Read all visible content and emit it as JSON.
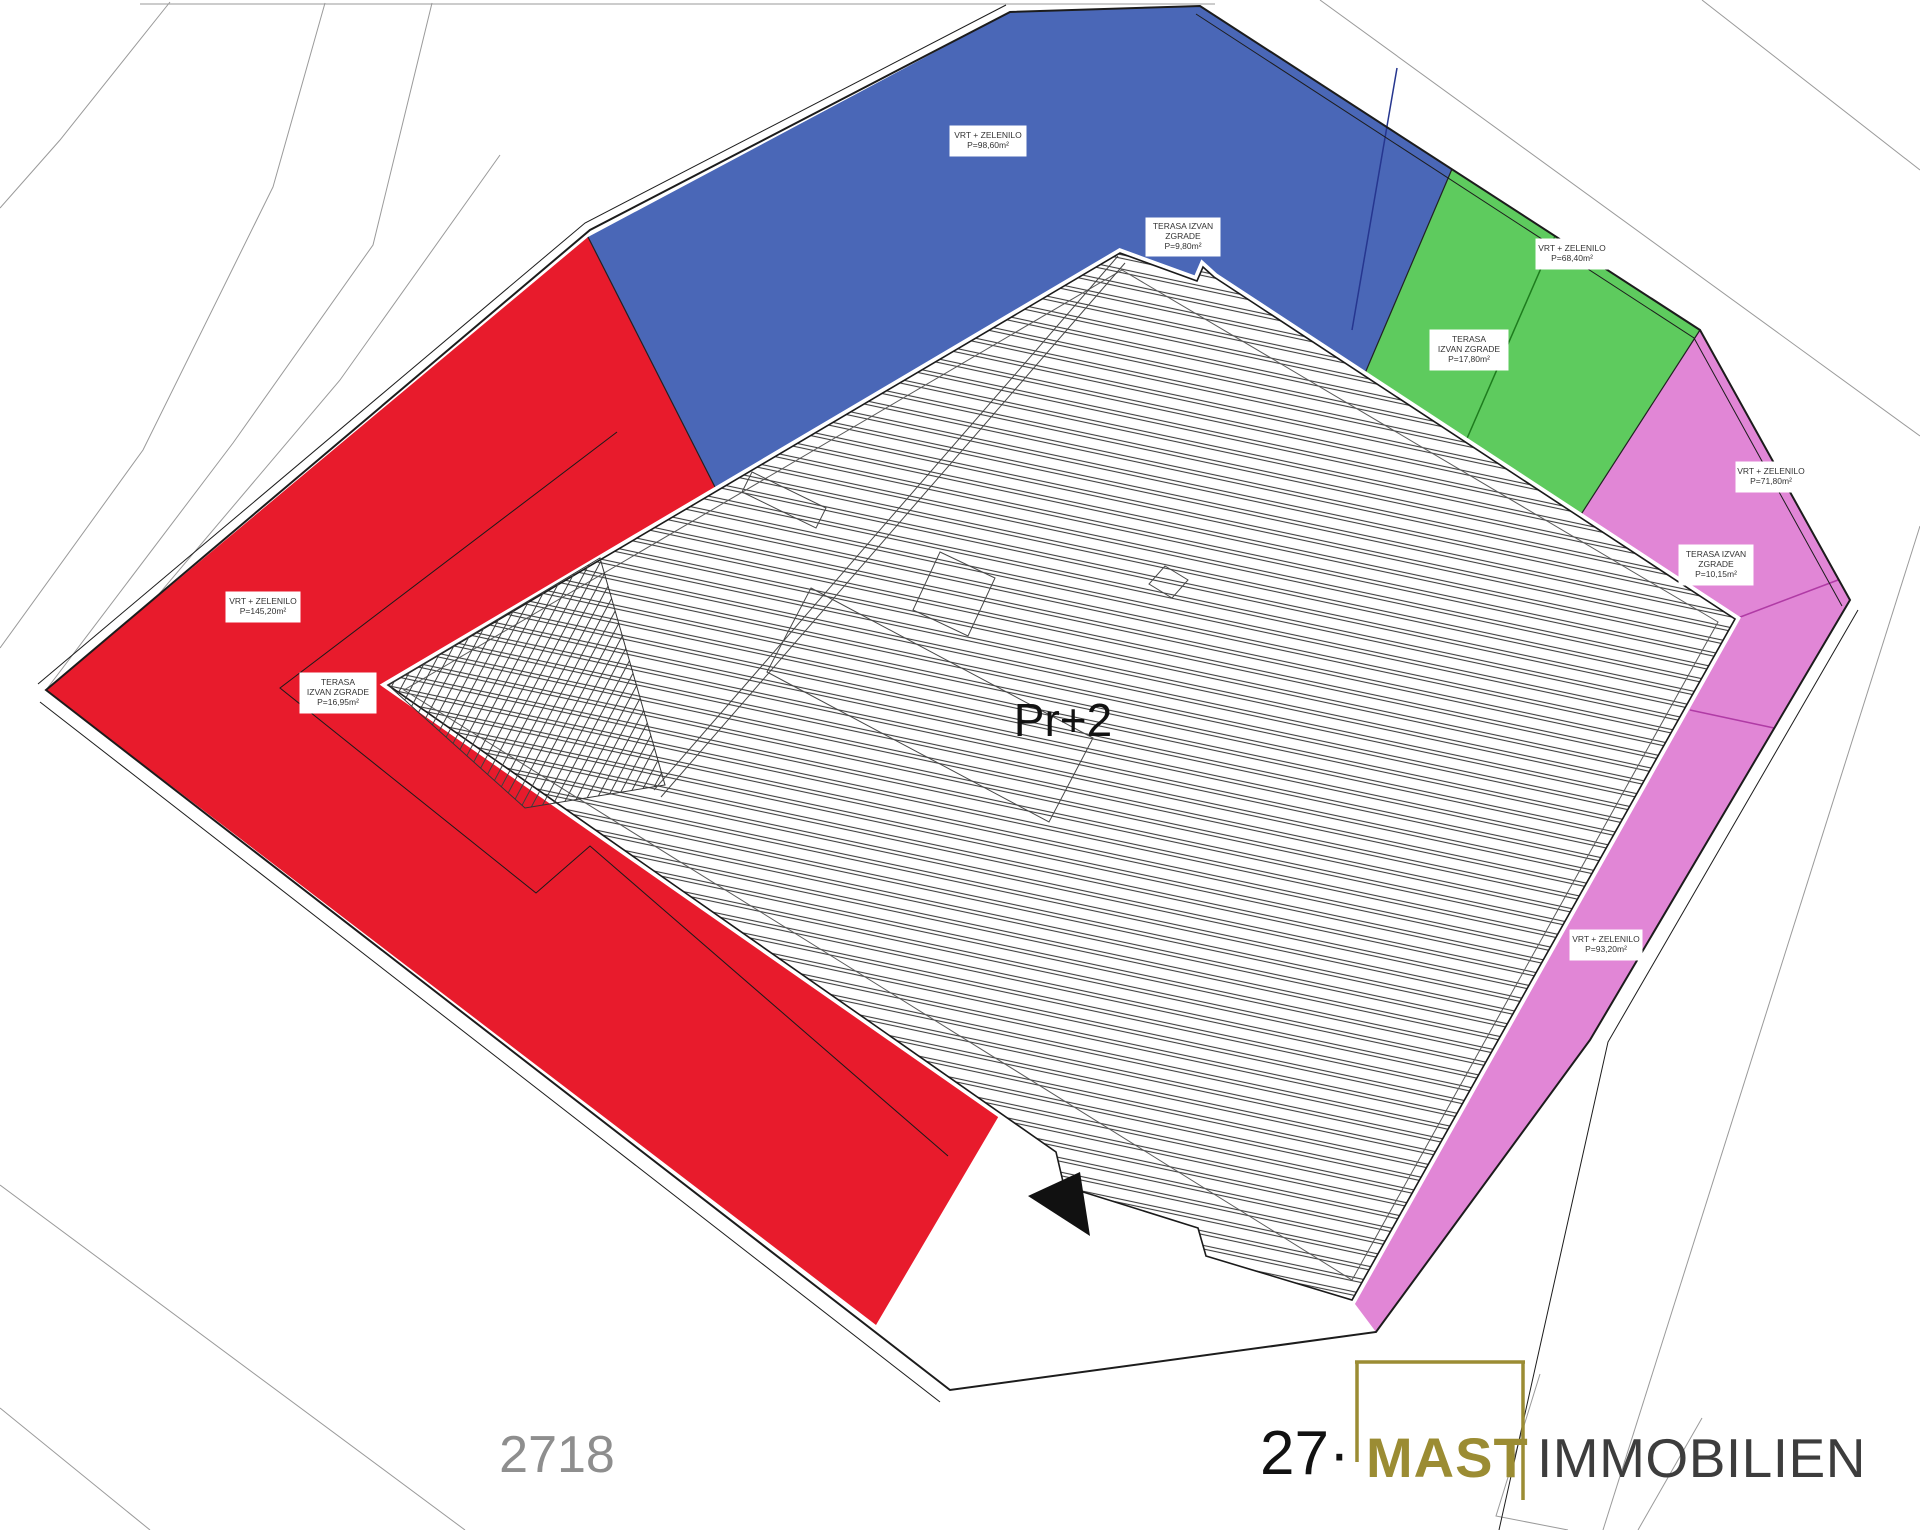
{
  "plan": {
    "floor_label": "Pr+2",
    "parcel_number": "2718"
  },
  "labels": {
    "blue_garden": [
      "VRT + ZELENILO",
      "P=98,60m²"
    ],
    "blue_terrace": [
      "TERASA IZVAN",
      "ZGRADE",
      "P=9,80m²"
    ],
    "green_garden": [
      "VRT + ZELENILO",
      "P=68,40m²"
    ],
    "green_terrace": [
      "TERASA",
      "IZVAN ZGRADE",
      "P=17,80m²"
    ],
    "pink_garden_upper": [
      "VRT + ZELENILO",
      "P=71,80m²"
    ],
    "pink_terrace": [
      "TERASA IZVAN",
      "ZGRADE",
      "P=10,15m²"
    ],
    "pink_garden_lower": [
      "VRT + ZELENILO",
      "P=93,20m²"
    ],
    "red_garden": [
      "VRT + ZELENILO",
      "P=145,20m²"
    ],
    "red_terrace": [
      "TERASA",
      "IZVAN ZGRADE",
      "P=16,95m²"
    ]
  },
  "logo": {
    "prefix": "27·",
    "brand": "MAST",
    "suffix": "IMMOBILIEN"
  },
  "colors": {
    "zone_red": "#e81b2c",
    "zone_blue": "#4a67b7",
    "zone_green": "#5ecb5e",
    "zone_pink": "#e186d6",
    "division_blue": "#26368f",
    "division_green": "#1e7c1e",
    "division_pink": "#b03ba5",
    "brand_gold": "#9b8c33",
    "parcel_text_gray": "#8e8e8e"
  }
}
